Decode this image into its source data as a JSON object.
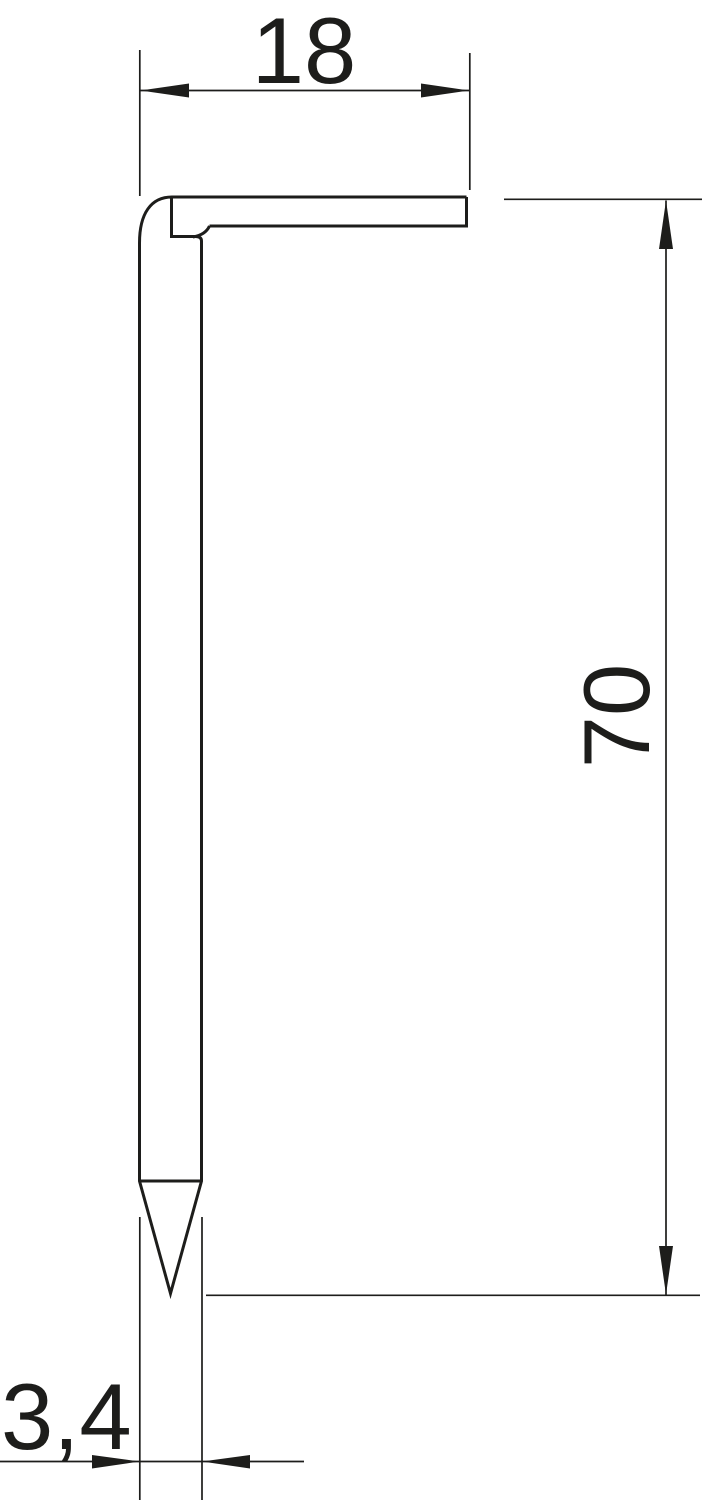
{
  "colors": {
    "background": "#ffffff",
    "line": "#1d1d1b"
  },
  "dimensions": {
    "head_width": "18",
    "length": "70",
    "diameter": "3,4"
  }
}
